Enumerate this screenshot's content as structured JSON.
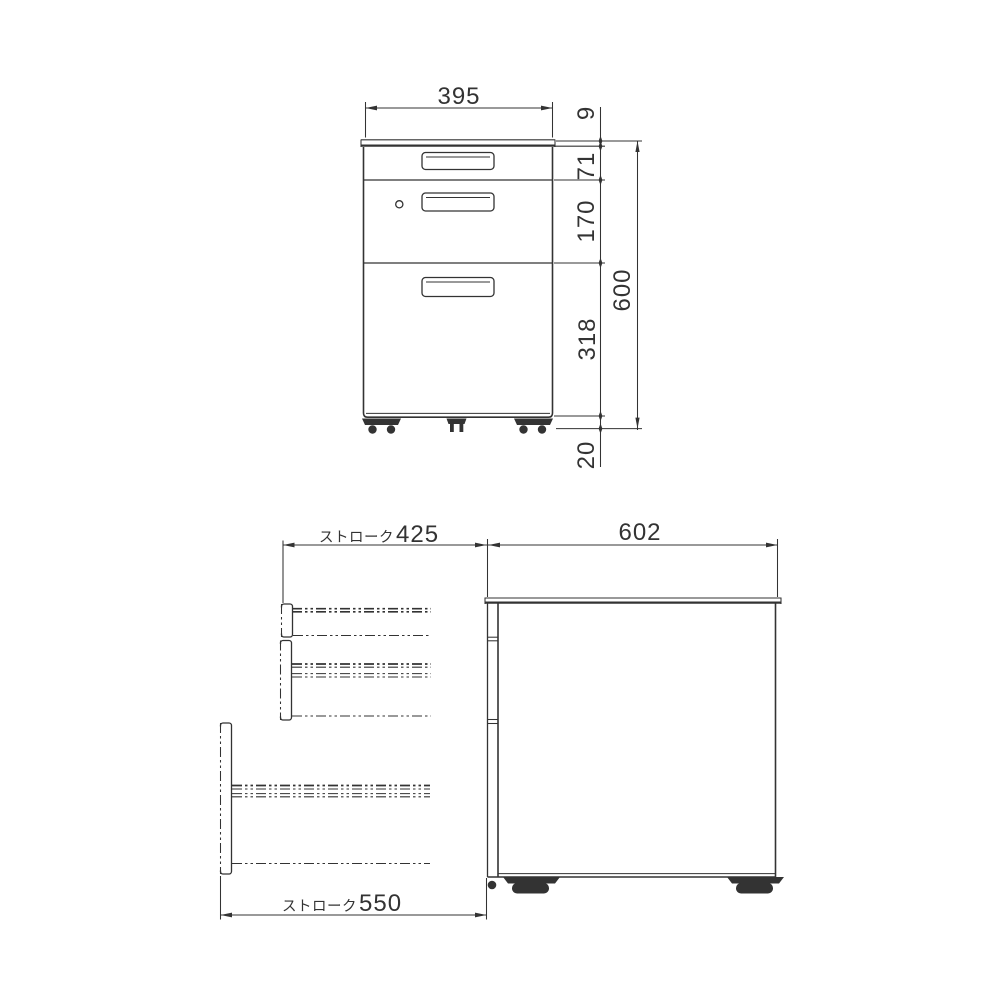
{
  "front_view": {
    "width": "395",
    "top_thickness": "9",
    "drawer1_height": "71",
    "drawer2_height": "170",
    "drawer3_height": "318",
    "total_height": "600",
    "caster_height": "20"
  },
  "side_view": {
    "depth": "602",
    "upper_stroke": {
      "prefix": "ストローク",
      "value": "425"
    },
    "lower_stroke": {
      "prefix": "ストローク",
      "value": "550"
    }
  },
  "colors": {
    "line": "#333333",
    "background": "#ffffff"
  }
}
